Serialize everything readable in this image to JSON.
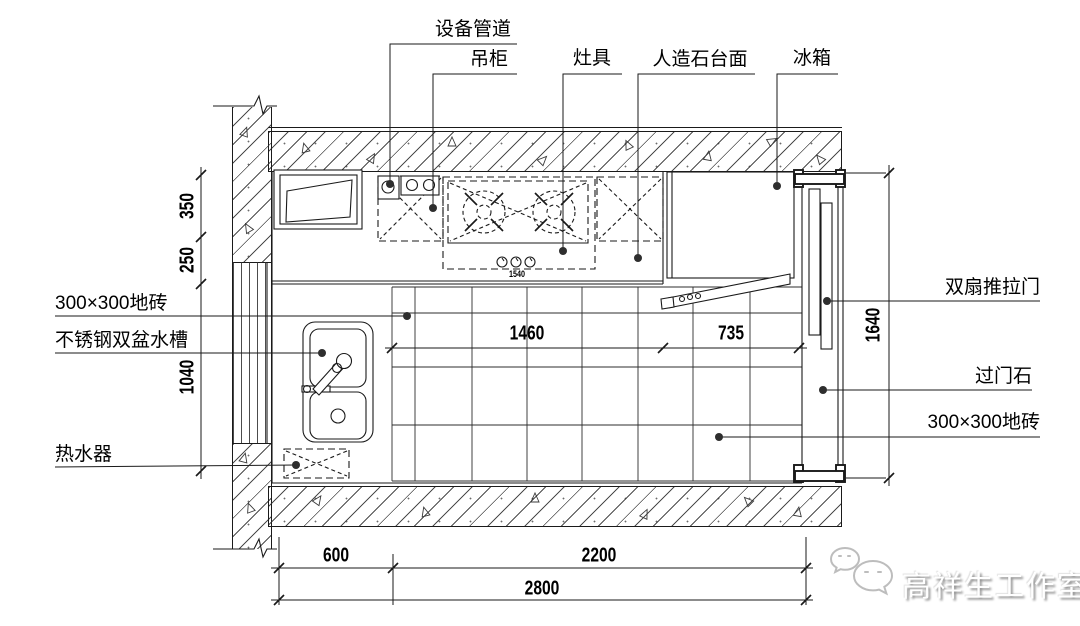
{
  "meta": {
    "drawing_type": "厨房平面图 (kitchen plan drawing)",
    "background_color": "#ffffff",
    "line_color": "#1a1a1a"
  },
  "callouts": {
    "top": [
      {
        "id": "equipment-pipe",
        "label": "设备管道"
      },
      {
        "id": "wall-cabinet",
        "label": "吊柜"
      },
      {
        "id": "stove",
        "label": "灶具"
      },
      {
        "id": "stone-countertop",
        "label": "人造石台面"
      },
      {
        "id": "fridge",
        "label": "冰箱"
      }
    ],
    "left": [
      {
        "id": "floor-tile-left",
        "label": "300×300地砖"
      },
      {
        "id": "steel-sink",
        "label": "不锈钢双盆水槽"
      },
      {
        "id": "water-heater",
        "label": "热水器"
      }
    ],
    "right": [
      {
        "id": "sliding-door",
        "label": "双扇推拉门"
      },
      {
        "id": "threshold-stone",
        "label": "过门石"
      },
      {
        "id": "floor-tile-right",
        "label": "300×300地砖"
      }
    ]
  },
  "dimensions": {
    "left_segments": [
      "350",
      "250",
      "1040"
    ],
    "door_opening_height": "1640",
    "interior": [
      "1460",
      "735"
    ],
    "bottom_segments": [
      "600",
      "2200"
    ],
    "bottom_total": "2800",
    "stove_width": "1540"
  },
  "watermark": {
    "studio": "高祥生工作室",
    "icon": "wechat-bubbles-icon"
  }
}
